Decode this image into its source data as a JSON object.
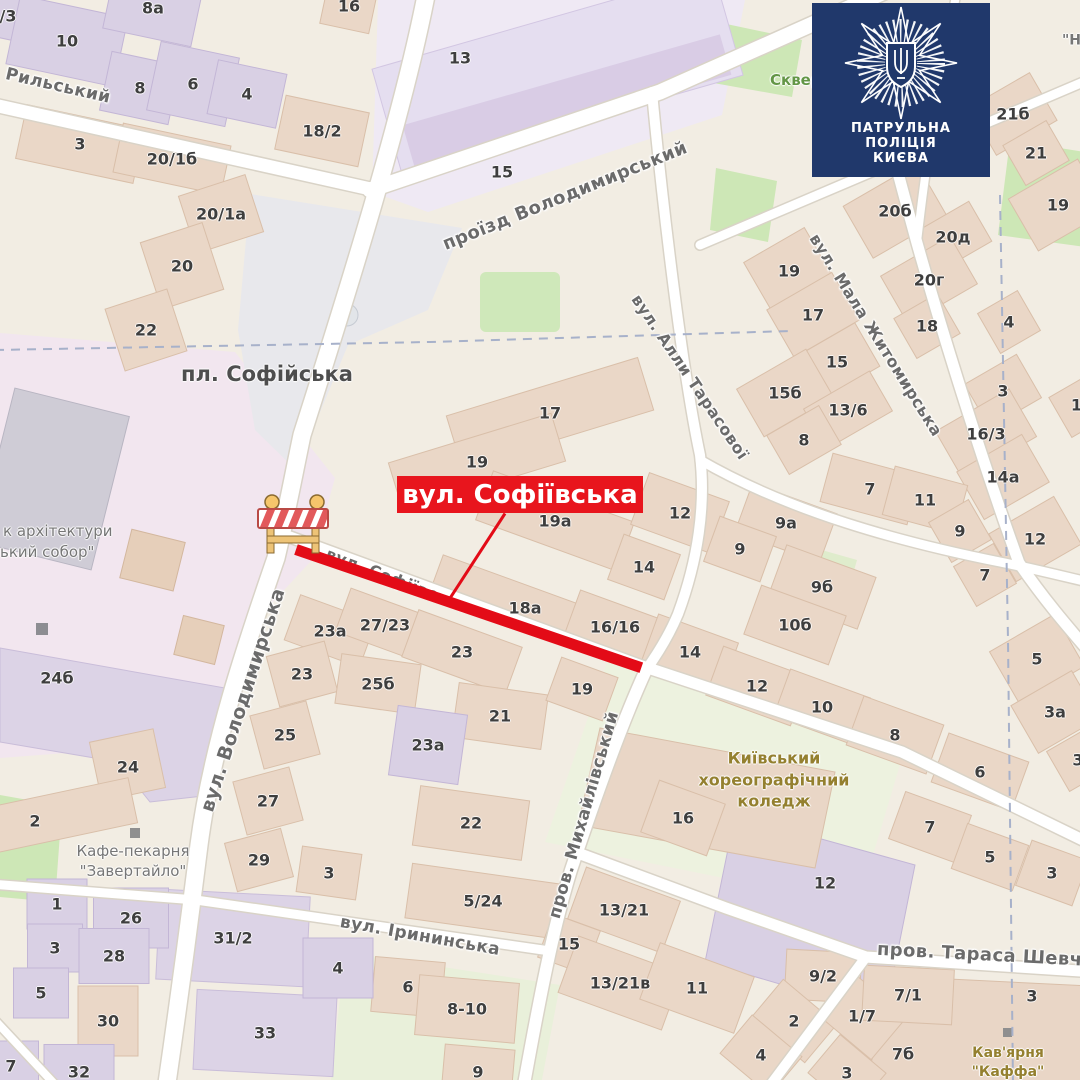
{
  "badge": {
    "lines": [
      "ПАТРУЛЬНА",
      "ПОЛІЦІЯ",
      "КИЄВА"
    ],
    "bg_color": "#20386b",
    "emblem": "police-star-trident"
  },
  "closure": {
    "banner_text": "вул. Софіївська",
    "banner_color": "#e8151d",
    "line_color": "#e30b17",
    "barrier_icon": "road-works-barrier"
  },
  "map": {
    "square_label": "пл. Софійська",
    "street_labels": [
      {
        "t": "Рильський",
        "x": 58,
        "y": 86,
        "rot": 13,
        "s": 17
      },
      {
        "t": "проїзд Володимирський",
        "x": 565,
        "y": 196,
        "rot": -22,
        "s": 18
      },
      {
        "t": "вул. Володимирська",
        "x": 243,
        "y": 700,
        "rot": -72,
        "s": 19
      },
      {
        "t": "вул. Алли Тарасової",
        "x": 690,
        "y": 377,
        "rot": 56,
        "s": 16
      },
      {
        "t": "вул. Мала Житомирська",
        "x": 876,
        "y": 335,
        "rot": 58,
        "s": 16
      },
      {
        "t": "пров. Михайлівський",
        "x": 584,
        "y": 815,
        "rot": -74,
        "s": 17
      },
      {
        "t": "вул. Ірининська",
        "x": 420,
        "y": 936,
        "rot": 10,
        "s": 17
      },
      {
        "t": "пров. Тараса Шевченка",
        "x": 1005,
        "y": 956,
        "rot": 3,
        "s": 18
      },
      {
        "t": "вул. Софіївська",
        "x": 397,
        "y": 580,
        "rot": 21,
        "s": 16
      }
    ],
    "poi_labels": [
      {
        "lines": [
          "пл. Софійська"
        ],
        "x": 267,
        "y": 374,
        "color": "#4e4e4e",
        "s": 21,
        "b": 1
      },
      {
        "lines": [
          "Кафе-пекарня",
          "\"Завертайло\""
        ],
        "x": 133,
        "y": 861,
        "color": "#767676",
        "s": 15
      },
      {
        "lines": [
          "Київський",
          "хореографічний",
          "коледж"
        ],
        "x": 774,
        "y": 780,
        "color": "#94802f",
        "s": 16,
        "b": 1
      },
      {
        "lines": [
          "Кав'ярня",
          "\"Каффа\""
        ],
        "x": 1008,
        "y": 1063,
        "color": "#94802f",
        "s": 14,
        "b": 1
      },
      {
        "lines": [
          "Сквер"
        ],
        "x": 770,
        "y": 80,
        "color": "#639646",
        "s": 15,
        "ax": "left",
        "b": 1
      },
      {
        "lines": [
          "к архітектури"
        ],
        "x": 3,
        "y": 531,
        "color": "#767676",
        "s": 15,
        "ax": "left"
      },
      {
        "lines": [
          "ький собор\""
        ],
        "x": 0,
        "y": 552,
        "color": "#767676",
        "s": 15,
        "ax": "left"
      },
      {
        "lines": [
          "\"Н"
        ],
        "x": 1062,
        "y": 41,
        "color": "#767676",
        "s": 14,
        "ax": "left",
        "b": 1
      }
    ],
    "house_numbers": [
      {
        "t": "/3",
        "x": 8,
        "y": 16,
        "r": 12,
        "c": "p"
      },
      {
        "t": "10",
        "x": 67,
        "y": 41,
        "r": 12,
        "c": "p",
        "w": 110,
        "h": 70
      },
      {
        "t": "8а",
        "x": 153,
        "y": 8,
        "r": 12,
        "c": "p",
        "w": 90,
        "h": 60
      },
      {
        "t": "8",
        "x": 140,
        "y": 88,
        "r": 12,
        "c": "p",
        "w": 70,
        "h": 60
      },
      {
        "t": "6",
        "x": 193,
        "y": 84,
        "r": 12,
        "c": "p",
        "w": 80,
        "h": 70
      },
      {
        "t": "4",
        "x": 247,
        "y": 94,
        "r": 12,
        "c": "p",
        "w": 70,
        "h": 55
      },
      {
        "t": "16",
        "x": 349,
        "y": 6,
        "r": 12
      },
      {
        "t": "18/2",
        "x": 322,
        "y": 131,
        "r": 12,
        "w": 85,
        "h": 55
      },
      {
        "t": "3",
        "x": 80,
        "y": 144,
        "r": 12,
        "w": 120,
        "h": 55
      },
      {
        "t": "20/1б",
        "x": 172,
        "y": 159,
        "r": 12,
        "w": 110,
        "h": 50
      },
      {
        "t": "20/1а",
        "x": 221,
        "y": 214,
        "r": -18,
        "w": 70,
        "h": 60
      },
      {
        "t": "20",
        "x": 182,
        "y": 266,
        "r": -18,
        "w": 65,
        "h": 70
      },
      {
        "t": "22",
        "x": 146,
        "y": 330,
        "r": -18,
        "w": 65,
        "h": 65
      },
      {
        "t": "13",
        "x": 460,
        "y": 58,
        "nb": 1
      },
      {
        "t": "15",
        "x": 502,
        "y": 172,
        "nb": 1
      },
      {
        "t": "21б",
        "x": 1013,
        "y": 114,
        "r": -30,
        "w": 70,
        "h": 55
      },
      {
        "t": "21",
        "x": 1036,
        "y": 153,
        "r": -30
      },
      {
        "t": "19",
        "x": 1058,
        "y": 205,
        "r": -30,
        "w": 80,
        "h": 60
      },
      {
        "t": "20б",
        "x": 895,
        "y": 211,
        "r": -30,
        "w": 85,
        "h": 60
      },
      {
        "t": "20д",
        "x": 953,
        "y": 237,
        "r": -30
      },
      {
        "t": "20г",
        "x": 929,
        "y": 280,
        "r": -30,
        "w": 80,
        "h": 55
      },
      {
        "t": "19",
        "x": 789,
        "y": 271,
        "r": -30,
        "w": 70,
        "h": 60
      },
      {
        "t": "17",
        "x": 813,
        "y": 315,
        "r": -30,
        "w": 75,
        "h": 55
      },
      {
        "t": "18",
        "x": 927,
        "y": 326,
        "r": -30
      },
      {
        "t": "4",
        "x": 1009,
        "y": 322,
        "r": -30
      },
      {
        "t": "15",
        "x": 837,
        "y": 362,
        "r": -30,
        "w": 70,
        "h": 50
      },
      {
        "t": "15б",
        "x": 785,
        "y": 393,
        "r": -30,
        "w": 80,
        "h": 55
      },
      {
        "t": "13/6",
        "x": 848,
        "y": 410,
        "r": -30
      },
      {
        "t": "8",
        "x": 804,
        "y": 440,
        "r": -30,
        "w": 60,
        "h": 45
      },
      {
        "t": "3",
        "x": 1003,
        "y": 391,
        "r": -30,
        "w": 60,
        "h": 50
      },
      {
        "t": "16/3",
        "x": 986,
        "y": 434,
        "r": -30,
        "w": 85,
        "h": 55
      },
      {
        "t": "14а",
        "x": 1003,
        "y": 477,
        "r": -30,
        "w": 75,
        "h": 55
      },
      {
        "t": "13",
        "x": 1082,
        "y": 405,
        "r": -30
      },
      {
        "t": "17",
        "x": 550,
        "y": 413,
        "r": -17,
        "w": 200,
        "h": 55
      },
      {
        "t": "19",
        "x": 477,
        "y": 462,
        "r": -17,
        "w": 170,
        "h": 50
      },
      {
        "t": "19а",
        "x": 555,
        "y": 521,
        "r": 20,
        "w": 150,
        "h": 52
      },
      {
        "t": "18а",
        "x": 525,
        "y": 608,
        "r": 20,
        "w": 190,
        "h": 44
      },
      {
        "t": "16/16",
        "x": 615,
        "y": 627,
        "r": 20,
        "w": 90,
        "h": 46
      },
      {
        "t": "14",
        "x": 644,
        "y": 567,
        "r": 20,
        "w": 60,
        "h": 48
      },
      {
        "t": "12",
        "x": 680,
        "y": 513,
        "r": 20,
        "w": 85,
        "h": 55
      },
      {
        "t": "9а",
        "x": 786,
        "y": 523,
        "r": 20,
        "w": 90,
        "h": 52
      },
      {
        "t": "9",
        "x": 740,
        "y": 549,
        "r": 20,
        "w": 60,
        "h": 48
      },
      {
        "t": "7",
        "x": 870,
        "y": 489,
        "r": 15,
        "w": 90,
        "h": 50
      },
      {
        "t": "11",
        "x": 925,
        "y": 500,
        "r": 15,
        "w": 75,
        "h": 50
      },
      {
        "t": "9",
        "x": 960,
        "y": 531,
        "r": -30
      },
      {
        "t": "12",
        "x": 1035,
        "y": 539,
        "r": -30,
        "w": 75,
        "h": 55
      },
      {
        "t": "7",
        "x": 985,
        "y": 575,
        "r": -30
      },
      {
        "t": "9б",
        "x": 822,
        "y": 587,
        "r": 20,
        "w": 95,
        "h": 55
      },
      {
        "t": "10б",
        "x": 795,
        "y": 625,
        "r": 20,
        "w": 90,
        "h": 52
      },
      {
        "t": "5",
        "x": 1037,
        "y": 659,
        "r": -30,
        "w": 75,
        "h": 60
      },
      {
        "t": "3а",
        "x": 1055,
        "y": 712,
        "r": -30,
        "w": 70,
        "h": 55
      },
      {
        "t": "3",
        "x": 1078,
        "y": 760,
        "r": -30
      },
      {
        "t": "23а",
        "x": 330,
        "y": 631,
        "r": 20,
        "w": 80,
        "h": 48
      },
      {
        "t": "27/23",
        "x": 385,
        "y": 625,
        "r": 20
      },
      {
        "t": "23",
        "x": 462,
        "y": 652,
        "r": 20,
        "w": 110,
        "h": 50
      },
      {
        "t": "23",
        "x": 302,
        "y": 674,
        "r": -15,
        "w": 60,
        "h": 52
      },
      {
        "t": "25б",
        "x": 378,
        "y": 684,
        "r": 8,
        "w": 80,
        "h": 50
      },
      {
        "t": "21",
        "x": 500,
        "y": 716,
        "r": 8,
        "w": 90,
        "h": 55
      },
      {
        "t": "25",
        "x": 285,
        "y": 735,
        "r": -15,
        "w": 58,
        "h": 55
      },
      {
        "t": "23а",
        "x": 428,
        "y": 745,
        "r": 8,
        "c": "p",
        "w": 70,
        "h": 70
      },
      {
        "t": "27",
        "x": 268,
        "y": 801,
        "r": -15,
        "w": 58,
        "h": 55
      },
      {
        "t": "22",
        "x": 471,
        "y": 823,
        "r": 8,
        "w": 110,
        "h": 60
      },
      {
        "t": "29",
        "x": 259,
        "y": 860,
        "r": -15,
        "w": 58,
        "h": 50
      },
      {
        "t": "3",
        "x": 329,
        "y": 873,
        "r": 8,
        "w": 60,
        "h": 46
      },
      {
        "t": "19",
        "x": 582,
        "y": 689,
        "r": 20,
        "w": 60,
        "h": 46
      },
      {
        "t": "14",
        "x": 690,
        "y": 652,
        "r": 20,
        "w": 85,
        "h": 50
      },
      {
        "t": "12",
        "x": 757,
        "y": 686,
        "r": 20,
        "w": 90,
        "h": 52
      },
      {
        "t": "10",
        "x": 822,
        "y": 707,
        "r": 20,
        "w": 85,
        "h": 50
      },
      {
        "t": "8",
        "x": 895,
        "y": 735,
        "r": 20,
        "w": 85,
        "h": 52
      },
      {
        "t": "6",
        "x": 980,
        "y": 772,
        "r": 20,
        "w": 85,
        "h": 52
      },
      {
        "t": "16",
        "x": 683,
        "y": 818,
        "r": 20,
        "w": 70,
        "h": 55
      },
      {
        "t": "7",
        "x": 930,
        "y": 827,
        "r": 20,
        "w": 70,
        "h": 50
      },
      {
        "t": "5",
        "x": 990,
        "y": 857,
        "r": 20,
        "w": 65,
        "h": 48
      },
      {
        "t": "3",
        "x": 1052,
        "y": 873,
        "r": 20,
        "w": 60,
        "h": 48
      },
      {
        "t": "12",
        "x": 825,
        "y": 883,
        "c": "p",
        "nb": 1
      },
      {
        "t": "5/24",
        "x": 483,
        "y": 901,
        "r": 8,
        "w": 150,
        "h": 55
      },
      {
        "t": "13/21",
        "x": 624,
        "y": 910,
        "r": 20,
        "w": 100,
        "h": 55
      },
      {
        "t": "15",
        "x": 569,
        "y": 944,
        "r": 20
      },
      {
        "t": "13/21в",
        "x": 620,
        "y": 983,
        "r": 20,
        "w": 110,
        "h": 60
      },
      {
        "t": "11",
        "x": 697,
        "y": 988,
        "r": 20,
        "w": 100,
        "h": 60
      },
      {
        "t": "6",
        "x": 408,
        "y": 987,
        "r": 5,
        "w": 70,
        "h": 55
      },
      {
        "t": "8-10",
        "x": 467,
        "y": 1009,
        "r": 5,
        "w": 100,
        "h": 60
      },
      {
        "t": "9",
        "x": 478,
        "y": 1072,
        "r": 5,
        "w": 70,
        "h": 50
      },
      {
        "t": "4",
        "x": 338,
        "y": 968,
        "r": 0,
        "c": "p",
        "w": 70,
        "h": 60
      },
      {
        "t": "24б",
        "x": 57,
        "y": 678,
        "c": "p",
        "nb": 1
      },
      {
        "t": "24",
        "x": 128,
        "y": 767,
        "c": "p",
        "nb": 1
      },
      {
        "t": "2",
        "x": 35,
        "y": 821,
        "r": -12,
        "w": 200,
        "h": 46
      },
      {
        "t": "1",
        "x": 57,
        "y": 904,
        "c": "p",
        "w": 60,
        "h": 50
      },
      {
        "t": "26",
        "x": 131,
        "y": 918,
        "c": "p",
        "w": 75,
        "h": 60
      },
      {
        "t": "3",
        "x": 55,
        "y": 948,
        "c": "p",
        "w": 55,
        "h": 48
      },
      {
        "t": "28",
        "x": 114,
        "y": 956,
        "c": "p",
        "w": 70,
        "h": 55
      },
      {
        "t": "5",
        "x": 41,
        "y": 993,
        "c": "p",
        "w": 55,
        "h": 50
      },
      {
        "t": "30",
        "x": 108,
        "y": 1021,
        "w": 60,
        "h": 70
      },
      {
        "t": "7",
        "x": 11,
        "y": 1066,
        "c": "p",
        "w": 55,
        "h": 50
      },
      {
        "t": "32",
        "x": 79,
        "y": 1072,
        "c": "p",
        "w": 70,
        "h": 55
      },
      {
        "t": "31/2",
        "x": 233,
        "y": 938,
        "c": "p",
        "nb": 1
      },
      {
        "t": "33",
        "x": 265,
        "y": 1033,
        "c": "p",
        "nb": 1
      },
      {
        "t": "9/2",
        "x": 823,
        "y": 976,
        "r": 3,
        "w": 75,
        "h": 50
      },
      {
        "t": "2",
        "x": 794,
        "y": 1021,
        "r": 40,
        "w": 70,
        "h": 50
      },
      {
        "t": "4",
        "x": 761,
        "y": 1055,
        "r": 40,
        "w": 65,
        "h": 50
      },
      {
        "t": "1/7",
        "x": 862,
        "y": 1016,
        "r": 40,
        "w": 70,
        "h": 55
      },
      {
        "t": "7/1",
        "x": 908,
        "y": 995,
        "r": 3,
        "w": 90,
        "h": 55
      },
      {
        "t": "7б",
        "x": 903,
        "y": 1054,
        "r": 3,
        "nb": 1
      },
      {
        "t": "3",
        "x": 847,
        "y": 1073,
        "r": 40,
        "w": 60,
        "h": 50
      },
      {
        "t": "3",
        "x": 1032,
        "y": 996,
        "r": -30,
        "nb": 1
      }
    ]
  }
}
